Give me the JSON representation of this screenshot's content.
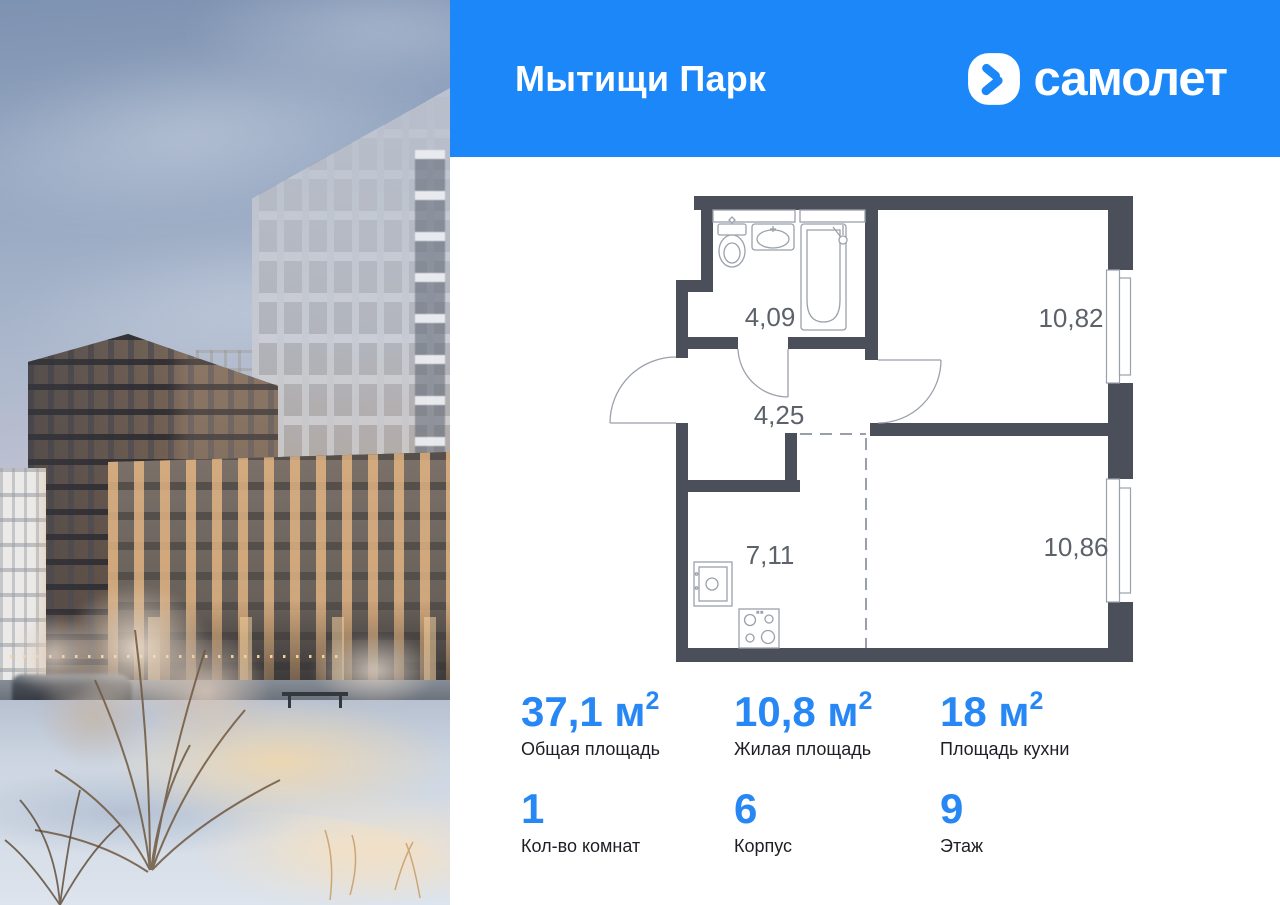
{
  "header": {
    "project_title": "Мытищи Парк",
    "brand_name": "самолет",
    "bg_color": "#1b87f8"
  },
  "floor_plan": {
    "wall_color": "#4b4f5a",
    "line_color": "#9ba1ab",
    "label_color": "#5d616b",
    "rooms": [
      {
        "name": "bathroom",
        "area": "4,09"
      },
      {
        "name": "hallway",
        "area": "4,25"
      },
      {
        "name": "room-top",
        "area": "10,82"
      },
      {
        "name": "kitchen",
        "area": "7,11"
      },
      {
        "name": "room-bottom",
        "area": "10,86"
      }
    ]
  },
  "stats": {
    "accent_color": "#2787f5",
    "row1": [
      {
        "value": "37,1",
        "unit": " м",
        "sup": "2",
        "label": "Общая площадь"
      },
      {
        "value": "10,8",
        "unit": " м",
        "sup": "2",
        "label": "Жилая площадь"
      },
      {
        "value": "18",
        "unit": " м",
        "sup": "2",
        "label": "Площадь кухни"
      }
    ],
    "row2": [
      {
        "value": "1",
        "label": "Кол-во комнат"
      },
      {
        "value": "6",
        "label": "Корпус"
      },
      {
        "value": "9",
        "label": "Этаж"
      }
    ]
  }
}
